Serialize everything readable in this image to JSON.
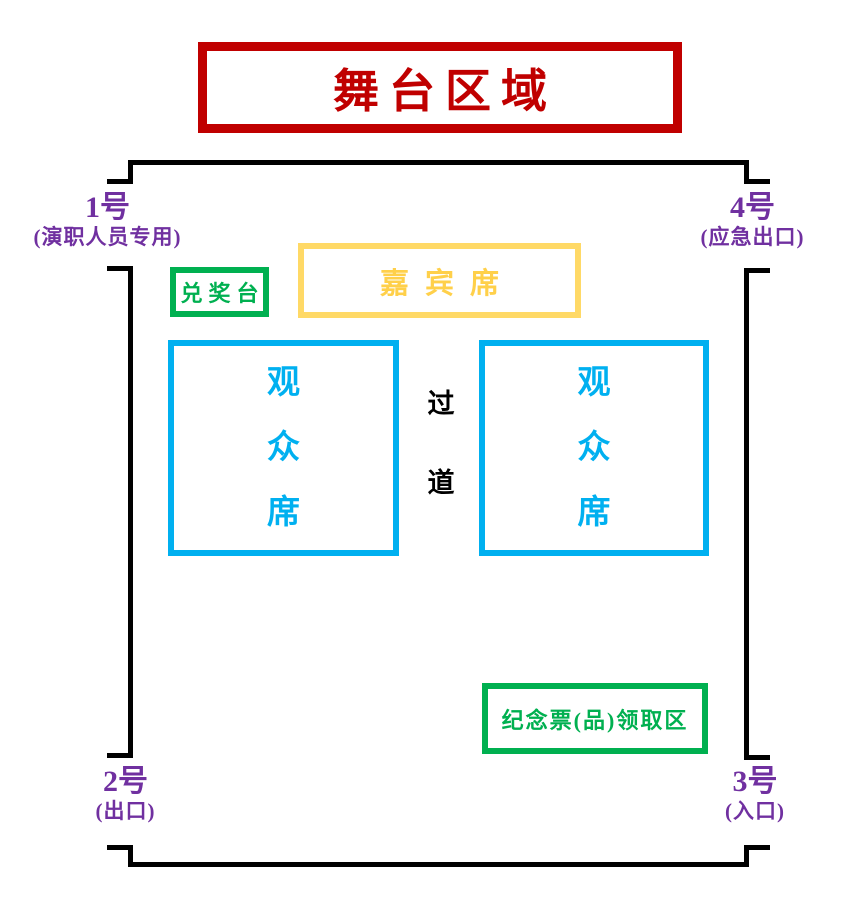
{
  "colors": {
    "stage_red": "#C00000",
    "wall_black": "#000000",
    "door_purple": "#7030A0",
    "green": "#00B050",
    "gold_border": "#FFD966",
    "gold_text": "#FFD04A",
    "blue": "#00B0F0"
  },
  "stage": {
    "label": "舞台区域"
  },
  "doors": {
    "door1": {
      "number": "1号",
      "note": "(演职人员专用)"
    },
    "door4": {
      "number": "4号",
      "note": "(应急出口)"
    },
    "door2": {
      "number": "2号",
      "note": "(出口)"
    },
    "door3": {
      "number": "3号",
      "note": "(入口)"
    }
  },
  "areas": {
    "prize_desk": {
      "label": "兑奖台"
    },
    "vip_seats": {
      "label": "嘉宾席"
    },
    "audience_left": {
      "chars": [
        "观",
        "众",
        "席"
      ]
    },
    "audience_right": {
      "chars": [
        "观",
        "众",
        "席"
      ]
    },
    "aisle": {
      "chars": [
        "过",
        "道"
      ]
    },
    "souvenir_pickup": {
      "label": "纪念票(品)领取区"
    }
  }
}
